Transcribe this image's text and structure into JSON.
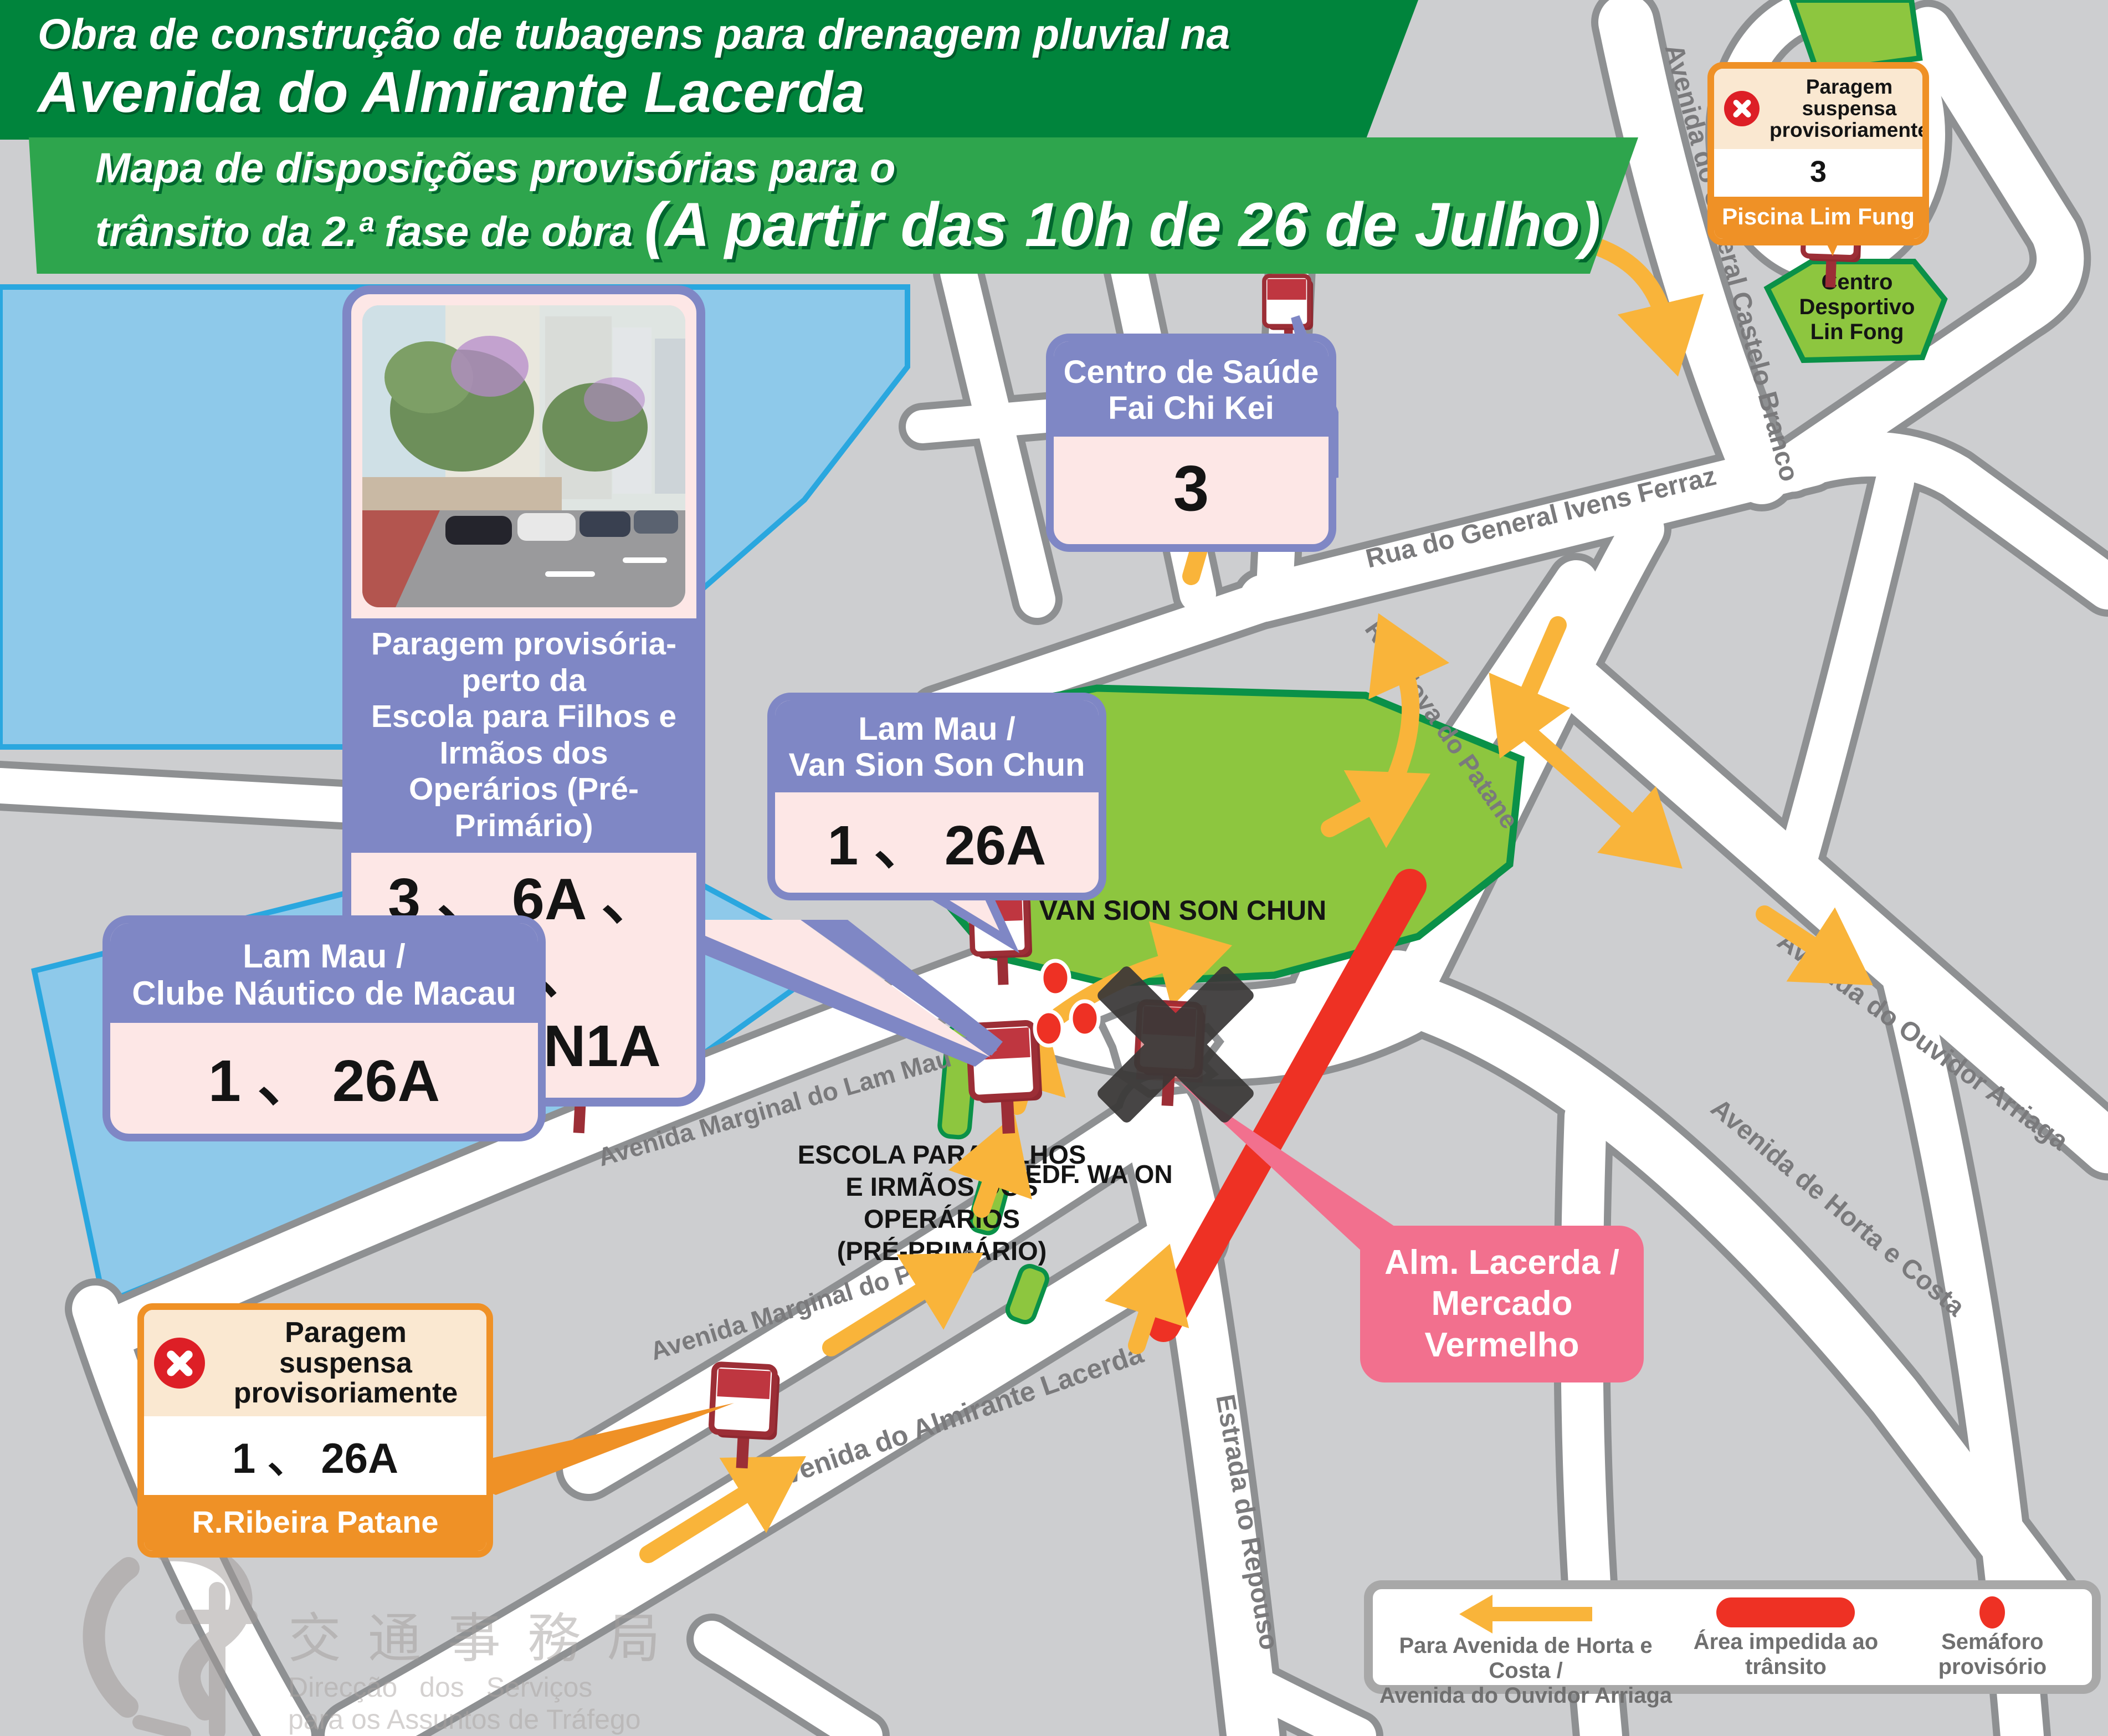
{
  "header": {
    "line1": "Obra de construção de tubagens para drenagem pluvial na",
    "line2": "Avenida do Almirante Lacerda",
    "line3": "Mapa de disposições provisórias para o",
    "line4_prefix": "trânsito da 2.ª fase de obra ",
    "line4_emphasis": "(A partir das 10h de 26 de Julho)"
  },
  "callouts": {
    "photo_stop": {
      "caption_lines": [
        "Paragem provisória-perto da",
        "Escola para Filhos e Irmãos dos",
        "Operários (Pré-Primário)"
      ],
      "routes_lines": [
        "3 、 6A 、 26 、",
        "33 、 N1A"
      ]
    },
    "van_sion": {
      "title_lines": [
        "Lam Mau /",
        "Van Sion Son Chun"
      ],
      "routes": "1 、 26A"
    },
    "clube_nautico": {
      "title_lines": [
        "Lam Mau /",
        "Clube Náutico de Macau"
      ],
      "routes": "1 、 26A"
    },
    "centro_saude": {
      "title_lines": [
        "Centro de Saúde",
        "Fai Chi Kei"
      ],
      "routes": "3"
    },
    "piscina": {
      "suspended_lines": [
        "Paragem suspensa",
        "provisoriamente"
      ],
      "routes": "3",
      "stop_name": "Piscina Lim Fung"
    },
    "ribeira": {
      "suspended_lines": [
        "Paragem suspensa",
        "provisoriamente"
      ],
      "routes": "1 、 26A",
      "stop_name": "R.Ribeira Patane"
    },
    "mercado": {
      "title_lines": [
        "Alm. Lacerda /",
        "Mercado Vermelho"
      ]
    }
  },
  "map_labels": {
    "castelo_branco": "Avenida do General Castelo Branco",
    "ivens_ferraz": "Rua do General Ivens Ferraz",
    "nova_patane": "Rua Nova do Patane",
    "ouvidor_arriaga": "Avenida do Ouvidor Arriaga",
    "horta_costa": "Avenida de Horta e Costa",
    "lam_mau": "Avenida Marginal do Lam Mau",
    "marginal_patane": "Avenida Marginal do Patane",
    "almirante_lacerda": "Avenida do Almirante Lacerda",
    "repouso": "Estrada do Repouso",
    "van_sion_park": "VAN SION SON CHUN",
    "edf_wa_on": "EDF. WA ON",
    "escola_lines": [
      "ESCOLA PARA FILHOS",
      "E IRMÃOS DOS",
      "OPERÁRIOS",
      "(PRÉ-PRIMÁRIO)"
    ],
    "lin_fong_lines": [
      "Centro",
      "Desportivo",
      "Lin Fong"
    ]
  },
  "legend": {
    "arrow_lines": [
      "Para Avenida de Horta e Costa /",
      "Avenida do Ouvidor Arriaga"
    ],
    "blocked_lines": [
      "Área impedida ao",
      "trânsito"
    ],
    "signal_lines": [
      "Semáforo",
      "provisório"
    ]
  },
  "logo": {
    "cjk": "交通事務局",
    "pt_line1": "Direcção  dos  Serviços",
    "pt_line2": "para os Assuntos de Tráfego"
  },
  "colors": {
    "header_dark_green": "#00843C",
    "header_light_green": "#2EA54D",
    "callout_purple": "#7F87C5",
    "callout_pink": "#FDE7E6",
    "suspended_orange": "#EF9126",
    "suspended_cream": "#FAE8D1",
    "highlight_pink": "#F2708E",
    "arrow_yellow": "#F9B43A",
    "blocked_red": "#EE3124",
    "park_green": "#8DC63F",
    "park_border": "#0A9148",
    "water_blue": "#8EC9EA",
    "water_border": "#2AA7DF",
    "bus_sign_red": "#BF3640",
    "street_white": "#FFFFFF",
    "block_gray": "#CDCED0"
  }
}
